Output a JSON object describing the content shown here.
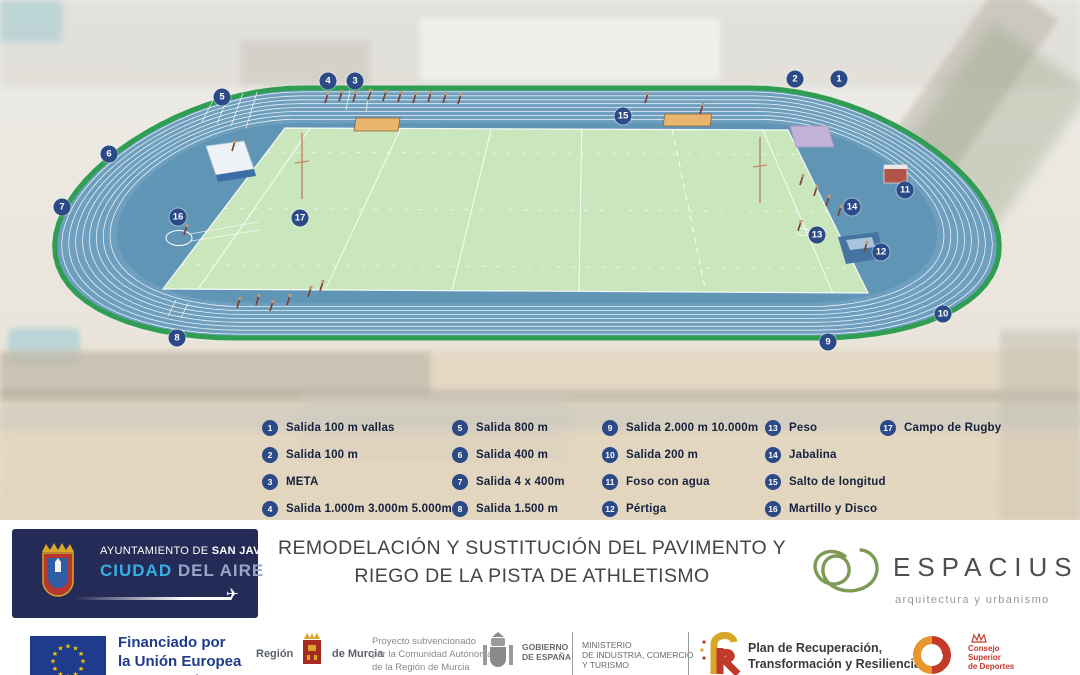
{
  "diagram": {
    "markers": [
      {
        "n": "1",
        "x": 839,
        "y": 79
      },
      {
        "n": "2",
        "x": 795,
        "y": 79
      },
      {
        "n": "3",
        "x": 355,
        "y": 81
      },
      {
        "n": "4",
        "x": 328,
        "y": 81
      },
      {
        "n": "5",
        "x": 222,
        "y": 97
      },
      {
        "n": "6",
        "x": 109,
        "y": 154
      },
      {
        "n": "7",
        "x": 62,
        "y": 207
      },
      {
        "n": "8",
        "x": 177,
        "y": 338
      },
      {
        "n": "9",
        "x": 828,
        "y": 342
      },
      {
        "n": "10",
        "x": 943,
        "y": 314
      },
      {
        "n": "11",
        "x": 905,
        "y": 190
      },
      {
        "n": "12",
        "x": 881,
        "y": 252
      },
      {
        "n": "13",
        "x": 817,
        "y": 235
      },
      {
        "n": "14",
        "x": 852,
        "y": 207
      },
      {
        "n": "15",
        "x": 623,
        "y": 116
      },
      {
        "n": "16",
        "x": 178,
        "y": 217
      },
      {
        "n": "17",
        "x": 300,
        "y": 218
      }
    ],
    "legend_columns": [
      {
        "items": [
          {
            "n": "1",
            "label": "Salida 100 m vallas"
          },
          {
            "n": "2",
            "label": "Salida 100 m"
          },
          {
            "n": "3",
            "label": "META"
          },
          {
            "n": "4",
            "label": "Salida 1.000m 3.000m 5.000m"
          }
        ]
      },
      {
        "items": [
          {
            "n": "5",
            "label": "Salida 800 m"
          },
          {
            "n": "6",
            "label": "Salida 400 m"
          },
          {
            "n": "7",
            "label": "Salida 4 x 400m"
          },
          {
            "n": "8",
            "label": "Salida 1.500 m"
          }
        ]
      },
      {
        "items": [
          {
            "n": "9",
            "label": "Salida 2.000 m 10.000m"
          },
          {
            "n": "10",
            "label": "Salida 200 m"
          },
          {
            "n": "11",
            "label": "Foso con agua"
          },
          {
            "n": "12",
            "label": "Pértiga"
          }
        ]
      },
      {
        "items": [
          {
            "n": "13",
            "label": "Peso"
          },
          {
            "n": "14",
            "label": "Jabalina"
          },
          {
            "n": "15",
            "label": "Salto de longitud"
          },
          {
            "n": "16",
            "label": "Martillo y Disco"
          }
        ]
      },
      {
        "items": [
          {
            "n": "17",
            "label": "Campo de Rugby"
          }
        ]
      }
    ]
  },
  "footer": {
    "sanjavier": {
      "line1_normal": "AYUNTAMIENTO DE ",
      "line1_bold": "SAN JAVIER",
      "ciudad": "CIUDAD",
      "delaire": " DEL AIRE"
    },
    "title_line1": "REMODELACIÓN Y SUSTITUCIÓN DEL PAVIMENTO Y",
    "title_line2": "RIEGO DE LA PISTA DE ATHLETISMO",
    "espacius": {
      "name": "ESPACIUS",
      "tagline": "arquitectura y urbanismo"
    }
  },
  "credits": {
    "eu": {
      "line1": "Financiado por",
      "line2": "la Unión Europea",
      "line3": "NextGenerationEU"
    },
    "murcia": {
      "left": "Región",
      "right": "de Murcia"
    },
    "subv": [
      "Proyecto subvencionado",
      "por la Comunidad Autónoma",
      "de la Región de Murcia"
    ],
    "gobierno": [
      "GOBIERNO",
      "DE ESPAÑA"
    ],
    "ministerio": [
      "MINISTERIO",
      "DE INDUSTRIA, COMERCIO",
      "Y TURISMO"
    ],
    "plan": [
      "Plan de Recuperación,",
      "Transformación y Resiliencia"
    ],
    "csd": [
      "Consejo",
      "Superior",
      "de Deportes"
    ]
  },
  "colors": {
    "track_blue": "#6f9fbe",
    "infield_blue": "#6195b6",
    "border_green": "#2f9e53",
    "field_green": "#c9e6bd",
    "marker_navy": "#2b4a87",
    "pit_sand": "#e9b56e",
    "eu_blue": "#1f3b8c",
    "espacius_green": "#7e9b55",
    "csd_red": "#c0392b"
  }
}
